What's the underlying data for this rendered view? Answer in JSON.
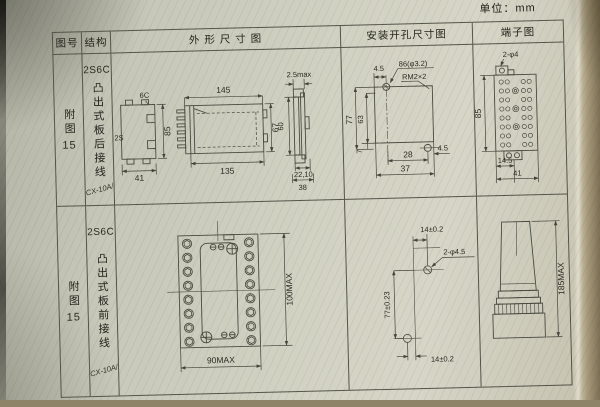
{
  "page": {
    "unit_label": "单位：mm"
  },
  "table": {
    "headers": {
      "fig_no": "图号",
      "structure": "结构",
      "outline": "外 形 尺 寸 图",
      "mounting": "安装开孔尺寸图",
      "terminal": "端子图"
    }
  },
  "rows": [
    {
      "fig_label": "附图",
      "fig_num": "15",
      "model": "2S6C",
      "structure_desc": "凸出式板后接线",
      "type_code": "JCX-10A/5",
      "outline": {
        "profile": {
          "tab_label": "6C",
          "side_label": "2S",
          "height": "85",
          "width": "41"
        },
        "side": {
          "width_top": "145",
          "width_bottom": "135",
          "height": "67"
        },
        "panel": {
          "thickness": "2.5max",
          "height": "60",
          "width_inner": "22,10",
          "width_outer": "38"
        }
      },
      "mounting": {
        "top_offset": "4.5",
        "hole_note": "86(φ3.2)",
        "thread_note": "RM2×2",
        "height_outer": "77",
        "height_inner": "63",
        "bottom_offset": "7",
        "width_inner": "28",
        "width_outer": "37",
        "side_offset": "4.5"
      },
      "terminal": {
        "hole_note": "2-φ4",
        "height": "85",
        "pitch": "14.5",
        "width": "41"
      }
    },
    {
      "fig_label": "附图",
      "fig_num": "15",
      "model": "2S6C",
      "structure_desc": "凸出式板前接线",
      "type_code": "JCX-10A/5",
      "outline": {
        "front": {
          "width": "90MAX",
          "height": "100MAX"
        }
      },
      "mounting": {
        "top_offset": "14±0.2",
        "hole_note": "2-φ4.5",
        "height": "77±0.23",
        "bottom_offset": "14±0.2"
      },
      "terminal": {
        "height": "185MAX"
      }
    }
  ]
}
